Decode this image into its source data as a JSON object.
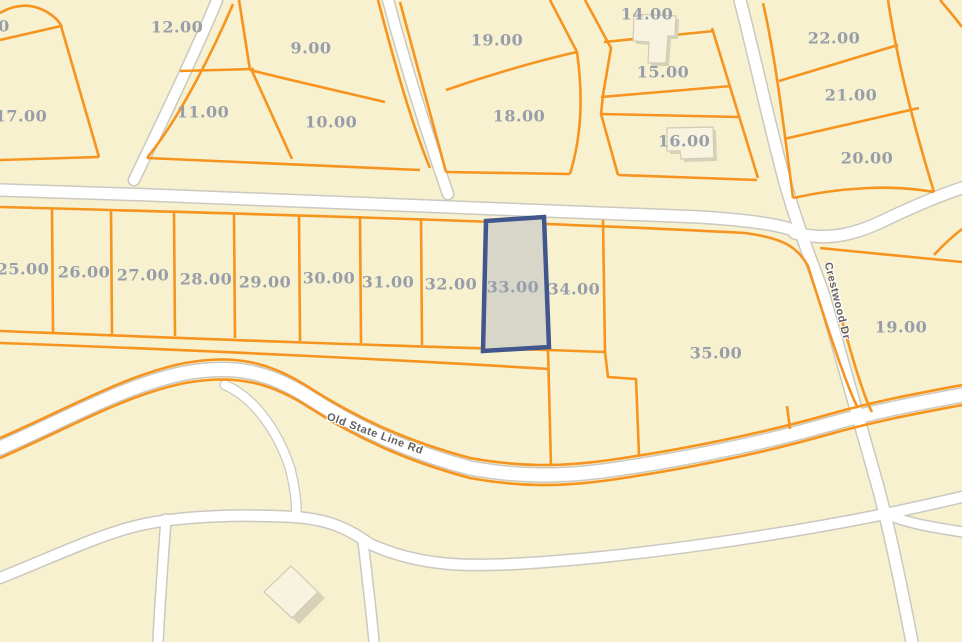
{
  "map": {
    "colors": {
      "background": "#f7f1d0",
      "parcel_line": "#f6941f",
      "road_fill": "#ffffff",
      "road_casing": "#cbc8bf",
      "parcel_label": "#989ea9",
      "road_label": "#606060",
      "selected_fill": "#d7d6c9",
      "selected_border": "#41568c",
      "building_fill": "#f8f3de",
      "building_stroke": "#cfcbb6",
      "building_shadow": "#d7d2b7"
    },
    "selected_parcel": {
      "label": "33.00"
    },
    "parcel_labels": [
      {
        "text": "0",
        "x": 4,
        "y": 26
      },
      {
        "text": "12.00",
        "x": 177,
        "y": 27
      },
      {
        "text": "9.00",
        "x": 311,
        "y": 48
      },
      {
        "text": "17.00",
        "x": 21,
        "y": 116
      },
      {
        "text": "11.00",
        "x": 203,
        "y": 112
      },
      {
        "text": "10.00",
        "x": 331,
        "y": 122
      },
      {
        "text": "19.00",
        "x": 497,
        "y": 40
      },
      {
        "text": "18.00",
        "x": 519,
        "y": 116
      },
      {
        "text": "14.00",
        "x": 647,
        "y": 14
      },
      {
        "text": "15.00",
        "x": 663,
        "y": 72
      },
      {
        "text": "16.00",
        "x": 684,
        "y": 141
      },
      {
        "text": "22.00",
        "x": 834,
        "y": 38
      },
      {
        "text": "21.00",
        "x": 851,
        "y": 95
      },
      {
        "text": "20.00",
        "x": 867,
        "y": 158
      },
      {
        "text": "25.00",
        "x": 23,
        "y": 269
      },
      {
        "text": "26.00",
        "x": 84,
        "y": 272
      },
      {
        "text": "27.00",
        "x": 143,
        "y": 275
      },
      {
        "text": "28.00",
        "x": 206,
        "y": 279
      },
      {
        "text": "29.00",
        "x": 265,
        "y": 282
      },
      {
        "text": "30.00",
        "x": 329,
        "y": 278
      },
      {
        "text": "31.00",
        "x": 388,
        "y": 282
      },
      {
        "text": "32.00",
        "x": 451,
        "y": 284
      },
      {
        "text": "33.00",
        "x": 513,
        "y": 287,
        "selected": true
      },
      {
        "text": "34.00",
        "x": 574,
        "y": 289
      },
      {
        "text": "35.00",
        "x": 716,
        "y": 353
      },
      {
        "text": "19.00",
        "x": 901,
        "y": 327
      }
    ],
    "road_labels": [
      {
        "text": "Old State Line Rd",
        "x": 375,
        "y": 434,
        "rotation": 20
      },
      {
        "text": "Crestwood Dr",
        "x": 837,
        "y": 301,
        "rotation": 76
      }
    ]
  }
}
